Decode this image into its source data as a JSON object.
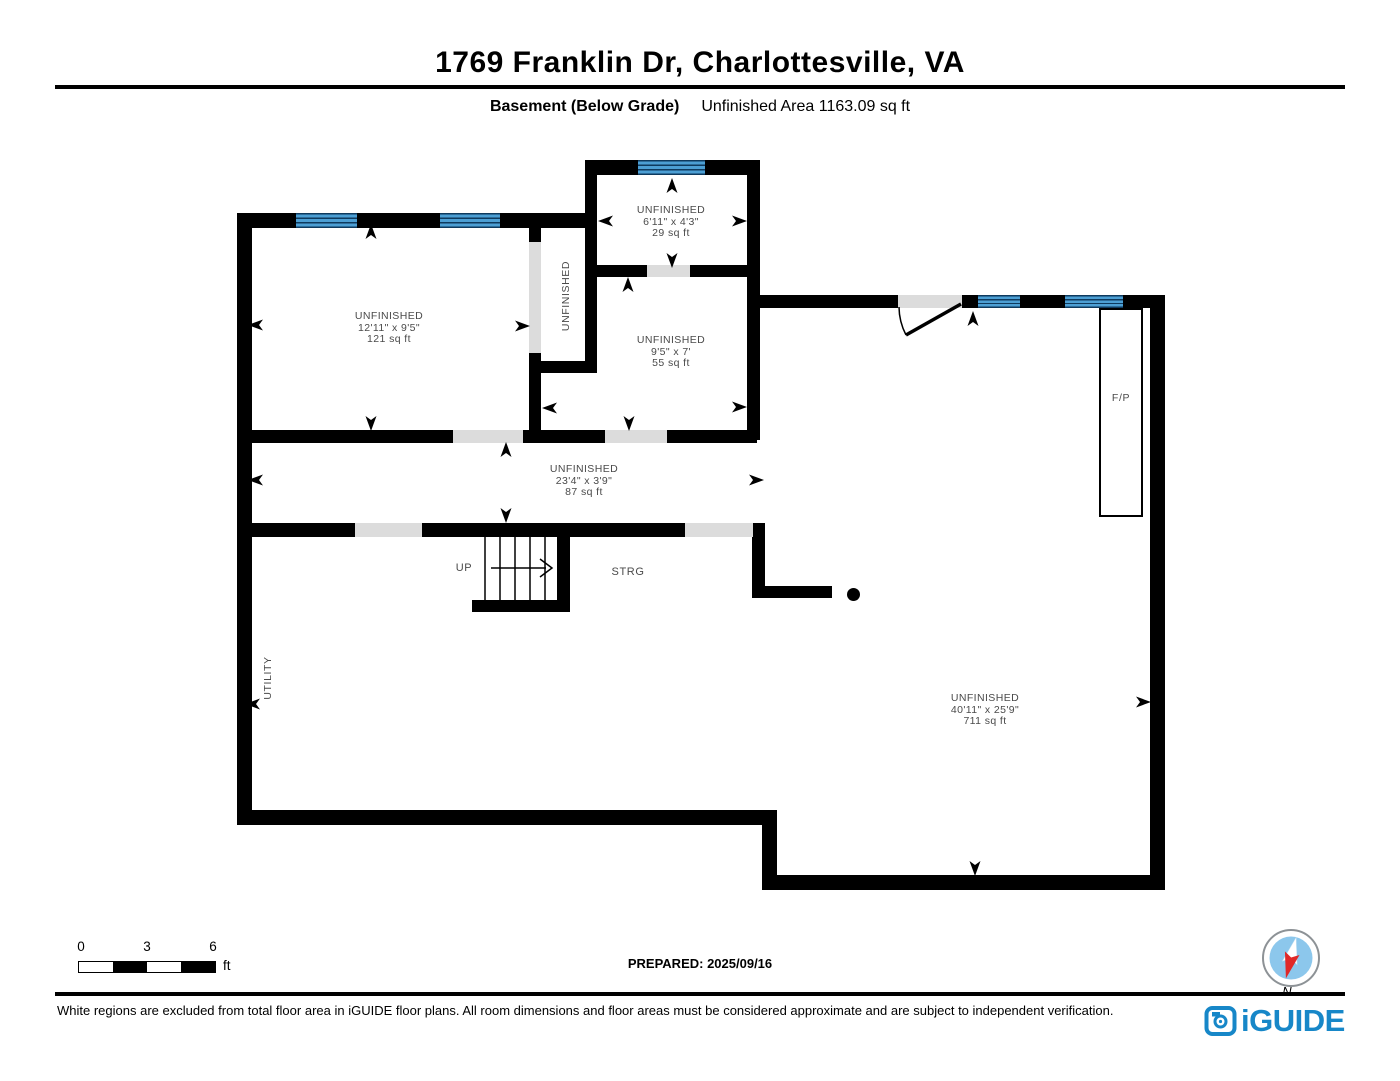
{
  "header": {
    "title": "1769 Franklin Dr, Charlottesville, VA",
    "floor_label": "Basement (Below Grade)",
    "area_label": "Unfinished Area 1163.09 sq ft"
  },
  "rooms": [
    {
      "name": "UNFINISHED",
      "dimensions": "6'11\" x 4'3\"",
      "area": "29 sq ft"
    },
    {
      "name": "UNFINISHED",
      "dimensions": "12'11\" x 9'5\"",
      "area": "121 sq ft"
    },
    {
      "name": "UNFINISHED",
      "dimensions": "9'5\" x 7'",
      "area": "55 sq ft"
    },
    {
      "name": "UNFINISHED",
      "dimensions": "23'4\" x 3'9\"",
      "area": "87 sq ft"
    },
    {
      "name": "UNFINISHED",
      "dimensions": "40'11\" x 25'9\"",
      "area": "711 sq ft"
    }
  ],
  "annotations": {
    "closet_label": "UNFINISHED",
    "utility_label": "UTILITY",
    "stairs_label": "UP",
    "storage_label": "STRG",
    "fireplace_label": "F/P"
  },
  "scale_bar": {
    "tick_0": "0",
    "tick_3": "3",
    "tick_6": "6",
    "unit": "ft"
  },
  "footer": {
    "prepared": "PREPARED: 2025/09/16",
    "compass_label": "N",
    "disclaimer": "White regions are excluded from total floor area in iGUIDE floor plans. All room dimensions and floor areas must be considered approximate and are subject to independent verification.",
    "brand": "iGUIDE"
  },
  "colors": {
    "wall": "#000000",
    "window_blue": "#4c9fd4",
    "window_frame": "#0e3a5e",
    "opening_gray": "#dcdcdc",
    "brand_blue": "#1787c8",
    "compass_red": "#e02828",
    "compass_disc": "#8cc7ec",
    "label_gray": "#4a4a4a"
  }
}
